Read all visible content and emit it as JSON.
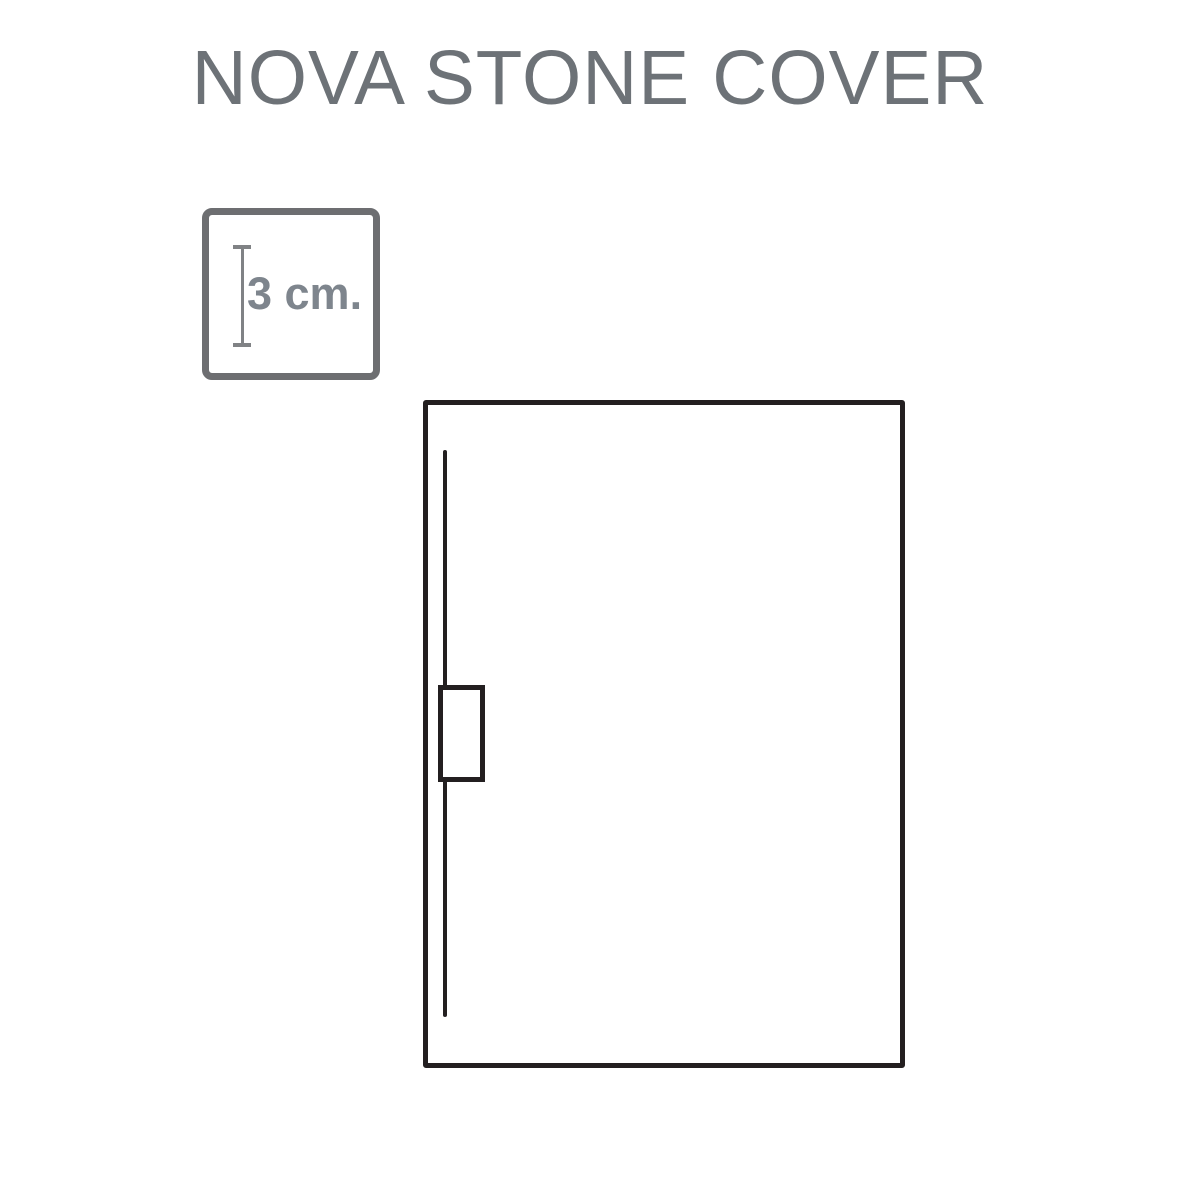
{
  "page": {
    "title": "NOVA STONE COVER",
    "title_color": "#6d7277",
    "background_color": "#ffffff"
  },
  "thickness_badge": {
    "label": "3 cm.",
    "label_color": "#7e858d",
    "border_color": "#6d6e71",
    "ruler_icon": "vertical-measure-ruler-icon",
    "ruler_color": "#808285"
  },
  "tray_diagram": {
    "description_elements": [
      "tray-outline",
      "drain-channel-line",
      "drain-outlet-box"
    ],
    "outline_color": "#231f20",
    "fill_color": "#ffffff"
  }
}
